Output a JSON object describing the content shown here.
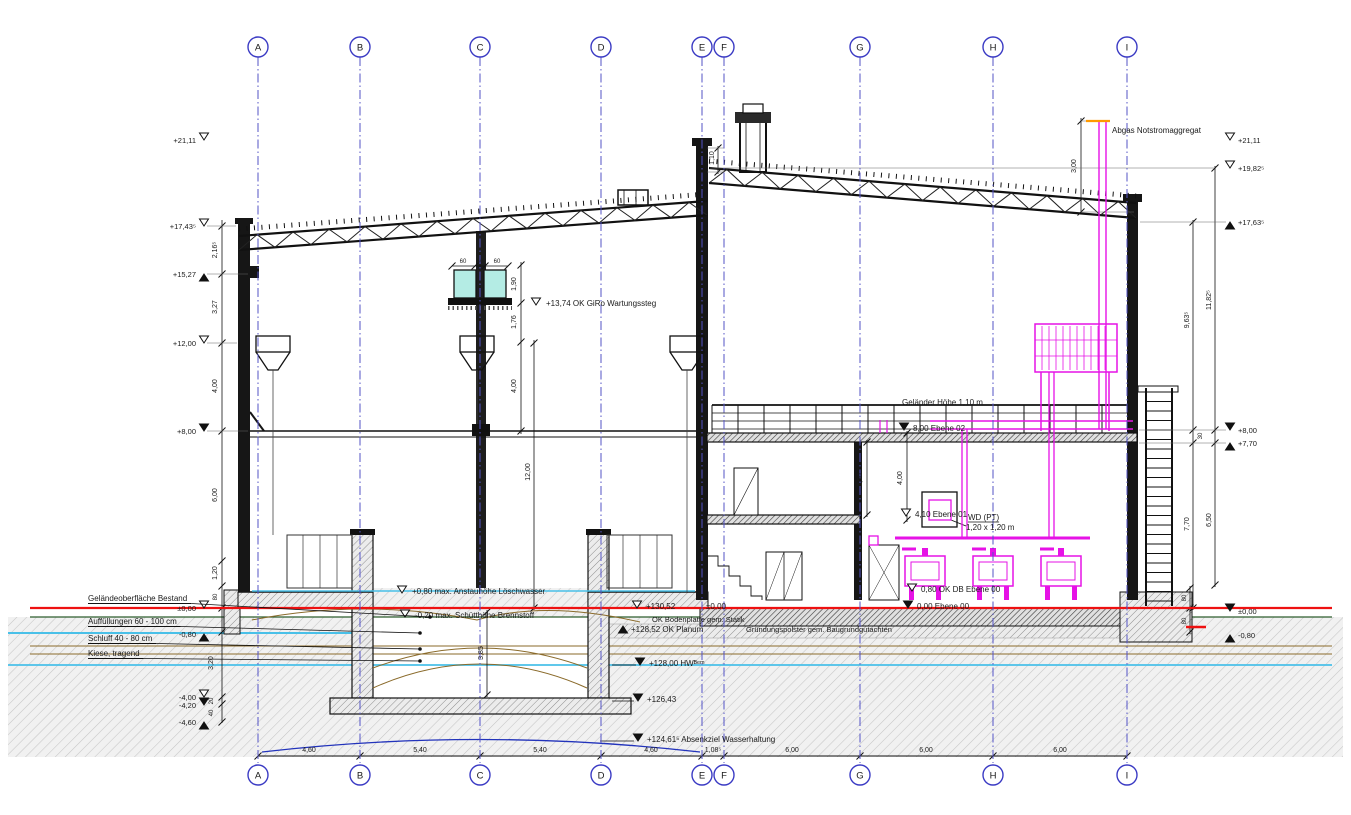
{
  "drawing": {
    "colors": {
      "axis": "#3b3bc4",
      "magenta": "#e612e6",
      "red": "#ee1111",
      "cyan": "#49c0e8",
      "cyan_fill": "#b4ece4",
      "green": "#2e5e2e",
      "olive": "#8a6a2a",
      "blue_curve": "#2233bb",
      "orange": "#ff9900"
    },
    "axes": [
      {
        "id": "A",
        "x": 258
      },
      {
        "id": "B",
        "x": 360
      },
      {
        "id": "C",
        "x": 480
      },
      {
        "id": "D",
        "x": 601
      },
      {
        "id": "E",
        "x": 702
      },
      {
        "id": "F",
        "x": 724
      },
      {
        "id": "G",
        "x": 860
      },
      {
        "id": "H",
        "x": 993
      },
      {
        "id": "I",
        "x": 1127
      }
    ],
    "bottom_dims": [
      {
        "t": "4,60",
        "x": 309
      },
      {
        "t": "5,40",
        "x": 420
      },
      {
        "t": "5,40",
        "x": 540
      },
      {
        "t": "4,60",
        "x": 651
      },
      {
        "t": "1,08⁵",
        "x": 713
      },
      {
        "t": "6,00",
        "x": 792
      },
      {
        "t": "6,00",
        "x": 926
      },
      {
        "t": "6,00",
        "x": 1060
      }
    ],
    "left_levels": [
      {
        "t": "+21,11",
        "y": 140,
        "m": "od"
      },
      {
        "t": "+17,43⁵",
        "y": 226,
        "m": "od"
      },
      {
        "t": "+15,27",
        "y": 274,
        "m": "fu"
      },
      {
        "t": "+12,00",
        "y": 343,
        "m": "od"
      },
      {
        "t": "+8,00",
        "y": 431,
        "m": "fd"
      },
      {
        "t": "±0,00",
        "y": 608,
        "m": "od"
      },
      {
        "t": "-0,80",
        "y": 634,
        "m": "fu"
      },
      {
        "t": "-4,00",
        "y": 697,
        "m": "od"
      },
      {
        "t": "-4,20",
        "y": 705,
        "m": "fd"
      },
      {
        "t": "-4,60",
        "y": 722,
        "m": "fu"
      }
    ],
    "right_levels": [
      {
        "t": "+21,11",
        "y": 140,
        "m": "od"
      },
      {
        "t": "+19,82⁵",
        "y": 168,
        "m": "od"
      },
      {
        "t": "+17,63⁵",
        "y": 222,
        "m": "fu"
      },
      {
        "t": "+8,00",
        "y": 430,
        "m": "fd"
      },
      {
        "t": "+7,70",
        "y": 443,
        "m": "fu"
      },
      {
        "t": "±0,00",
        "y": 611,
        "m": "fd"
      },
      {
        "t": "-0,80",
        "y": 635,
        "m": "fu"
      }
    ],
    "left_dims": [
      {
        "t": "2,16⁵",
        "x": 217,
        "y": 250
      },
      {
        "t": "3,27",
        "x": 217,
        "y": 307
      },
      {
        "t": "4,00",
        "x": 217,
        "y": 386
      },
      {
        "t": "6,00",
        "x": 217,
        "y": 495
      },
      {
        "t": "1,20",
        "x": 217,
        "y": 573
      },
      {
        "t": "80",
        "x": 217,
        "y": 597,
        "s": 6
      },
      {
        "t": "3,20",
        "x": 213,
        "y": 663
      },
      {
        "t": "20",
        "x": 213,
        "y": 701,
        "s": 6
      },
      {
        "t": "40",
        "x": 213,
        "y": 713,
        "s": 6
      }
    ],
    "misc_dims": [
      {
        "t": "1,90",
        "x": 516,
        "y": 284
      },
      {
        "t": "1,76",
        "x": 516,
        "y": 322
      },
      {
        "t": "4,00",
        "x": 516,
        "y": 386
      },
      {
        "t": "12,00",
        "x": 530,
        "y": 472
      },
      {
        "t": "3,85",
        "x": 483,
        "y": 653
      },
      {
        "t": "3,90",
        "x": 862,
        "y": 480
      },
      {
        "t": "4,00",
        "x": 902,
        "y": 478
      },
      {
        "t": "3,00",
        "x": 1076,
        "y": 166
      },
      {
        "t": "1,10",
        "x": 714,
        "y": 158
      },
      {
        "t": "9,63⁵",
        "x": 1189,
        "y": 320
      },
      {
        "t": "11,82⁵",
        "x": 1211,
        "y": 300
      },
      {
        "t": "30",
        "x": 1202,
        "y": 436,
        "s": 6
      },
      {
        "t": "7,70",
        "x": 1189,
        "y": 524
      },
      {
        "t": "6,50",
        "x": 1211,
        "y": 520
      },
      {
        "t": "80",
        "x": 1186,
        "y": 598,
        "s": 6
      },
      {
        "t": "80",
        "x": 1186,
        "y": 621,
        "s": 6
      }
    ],
    "box_dims": [
      {
        "t": "60",
        "x": 463
      },
      {
        "t": "50",
        "x": 480
      },
      {
        "t": "60",
        "x": 497
      }
    ],
    "annotations": [
      {
        "t": "+13,74 OK GiRo Wartungssteg",
        "x": 546,
        "y": 306,
        "m": "od",
        "mx": 536,
        "my": 305
      },
      {
        "t": "Geländer Höhe 1,10 m",
        "x": 902,
        "y": 405
      },
      {
        "t": "8,00 Ebene 02",
        "x": 913,
        "y": 431,
        "m": "fd",
        "mx": 904,
        "my": 430
      },
      {
        "t": "4,10 Ebene 01",
        "x": 915,
        "y": 517,
        "m": "od",
        "mx": 906,
        "my": 516
      },
      {
        "t": "WD (PT)",
        "x": 968,
        "y": 520,
        "u": 1
      },
      {
        "t": "1,20 x 1,20 m",
        "x": 966,
        "y": 530
      },
      {
        "t": "0,80 OK DB Ebene 00",
        "x": 921,
        "y": 592,
        "m": "od",
        "mx": 912,
        "my": 591
      },
      {
        "t": "0,00 Ebene 00",
        "x": 917,
        "y": 609,
        "m": "fd",
        "mx": 908,
        "my": 608
      },
      {
        "t": "Abgas Notstromaggregat",
        "x": 1112,
        "y": 133
      },
      {
        "t": "+130,52",
        "x": 646,
        "y": 609,
        "m": "od",
        "mx": 637,
        "my": 608
      },
      {
        "t": "±0,00",
        "x": 706,
        "y": 609
      },
      {
        "t": "OK Bodenplatte gem. Statik",
        "x": 652,
        "y": 622,
        "c": "#3a3a3a",
        "s": 7.5
      },
      {
        "t": "+128,52 OK Planum",
        "x": 631,
        "y": 632,
        "m": "fu",
        "mx": 623,
        "my": 626
      },
      {
        "t": "Gründungspolster gem. Baugrundgutachten",
        "x": 746,
        "y": 632,
        "c": "#3a3a3a",
        "s": 7.5
      },
      {
        "t": "+128,00 HWᴮᵉᵐ",
        "x": 649,
        "y": 666,
        "m": "fd",
        "mx": 640,
        "my": 665
      },
      {
        "t": "+126,43",
        "x": 647,
        "y": 702,
        "m": "fd",
        "mx": 638,
        "my": 701
      },
      {
        "t": "+124,61⁵ Absenkziel Wasserhaltung",
        "x": 647,
        "y": 742,
        "m": "fd",
        "mx": 638,
        "my": 741
      },
      {
        "t": "+0,80 max. Anstauhöhe Löschwasser",
        "x": 412,
        "y": 594,
        "m": "od",
        "mx": 402,
        "my": 593
      },
      {
        "t": "-0,20 max. Schütthöhe Brennstoff",
        "x": 415,
        "y": 618,
        "m": "od",
        "mx": 405,
        "my": 617
      }
    ],
    "ground_labels": [
      {
        "t": "Geländeoberfläche Bestand",
        "x": 88,
        "y": 601,
        "tx": 430,
        "ty": 617
      },
      {
        "t": "Auffüllungen 60 - 100 cm",
        "x": 88,
        "y": 624,
        "tx": 420,
        "ty": 633
      },
      {
        "t": "Schluff 40 - 80 cm",
        "x": 88,
        "y": 641,
        "tx": 420,
        "ty": 649
      },
      {
        "t": "Kiese, tragend",
        "x": 88,
        "y": 656,
        "tx": 420,
        "ty": 661
      }
    ]
  }
}
